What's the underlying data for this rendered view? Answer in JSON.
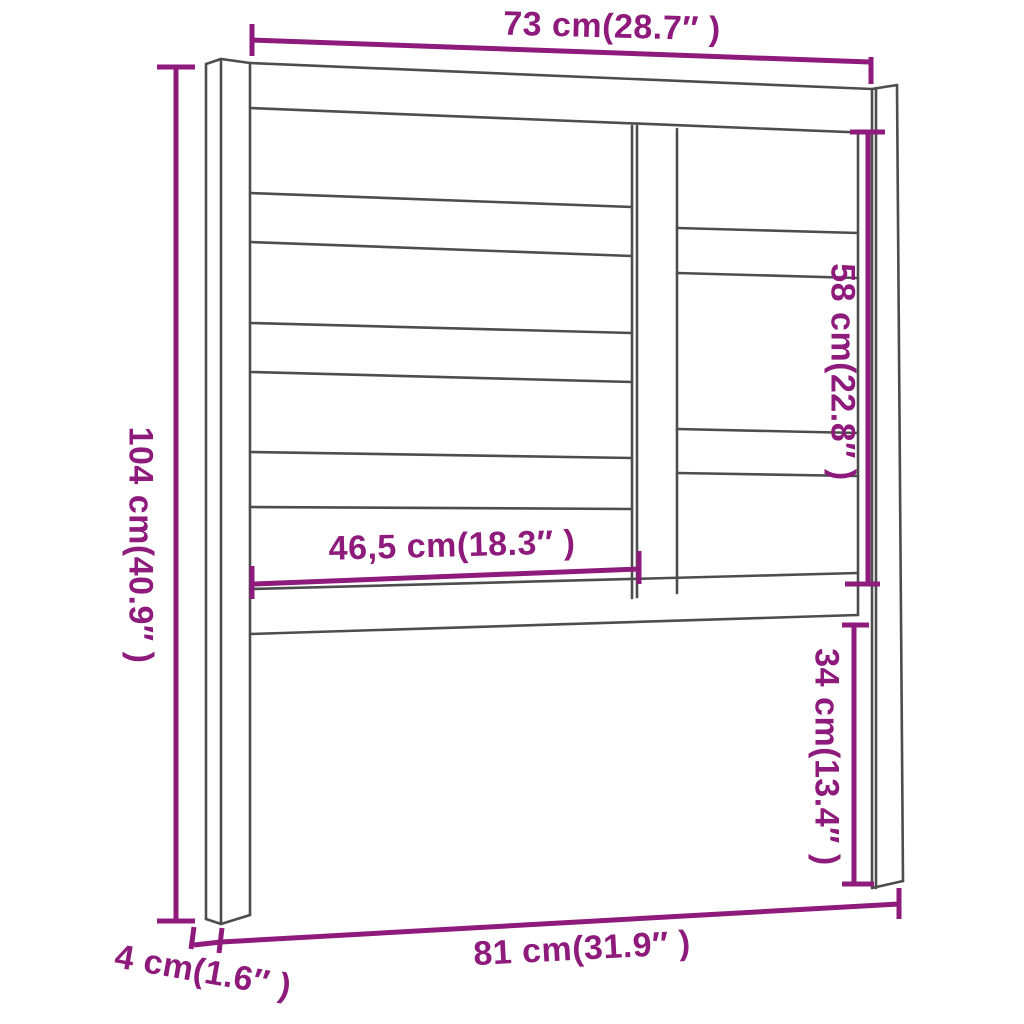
{
  "figure": {
    "type": "furniture-dimension-diagram",
    "subject": "bed headboard with slats and legs"
  },
  "colors": {
    "dimension": "#8e1a7b",
    "outline": "#4d4d4d",
    "background": "#ffffff"
  },
  "dimensions": {
    "top_width": {
      "label": "73 cm(28.7″ )"
    },
    "left_height": {
      "label": "104 cm(40.9″ )"
    },
    "right_inner_height": {
      "label": "58 cm(22.8″ )"
    },
    "slat_width": {
      "label": "46,5 cm(18.3″ )"
    },
    "leg_lower_height": {
      "label": "34 cm(13.4″ )"
    },
    "bottom_width": {
      "label": "81 cm(31.9″ )"
    },
    "leg_depth": {
      "label": "4 cm(1.6″ )"
    }
  }
}
